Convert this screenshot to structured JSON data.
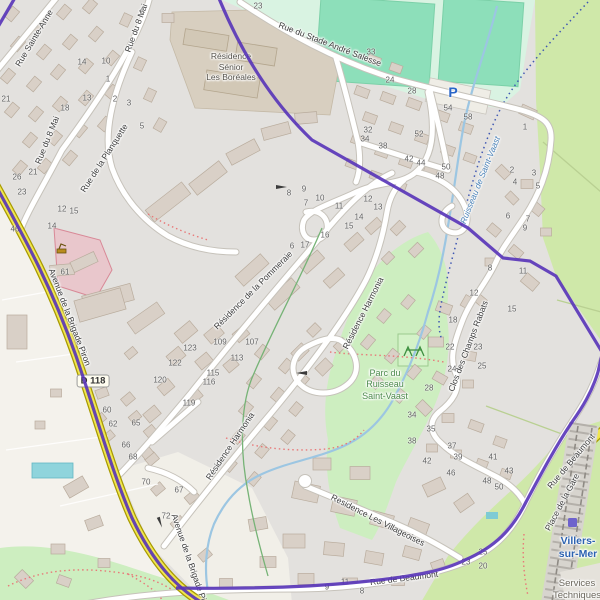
{
  "map": {
    "streets": {
      "sainte_anne": "Rue Sainte-Anne",
      "huit_mai": "Rue du 8 Mai",
      "stade": "Rue du Stade André Salesse",
      "planquette": "Rue de la Planquette",
      "pommeraie": "Résidence de la Pommeraie",
      "harmonia": "Résidence Harmonia",
      "champs_rabats": "Clos des Champs Rabats",
      "villageoises": "Residence Les Villageoises",
      "brigade": "Avenue de la Brigade Piron",
      "beaumont": "Rue de Beaumont",
      "gare": "Place de la Gare"
    },
    "places": {
      "boreales_line1": "Résidence",
      "boreales_line2": "Sénior",
      "boreales_line3": "Les Boréales",
      "parc_line1": "Parc du",
      "parc_line2": "Ruisseau",
      "parc_line3": "Saint-Vaast",
      "ruisseau": "Ruisseau de Saint-Vaast",
      "villers_line1": "Villers-",
      "villers_line2": "sur-Mer",
      "services_line1": "Services",
      "services_line2": "Techniques"
    },
    "markers": {
      "parking": "P",
      "road_ref": "D 118"
    },
    "colors": {
      "c-boundary": "#5633b8",
      "c-road": "#f0e64f",
      "c-water": "#9cc6e2",
      "c-park": "#cdeec0",
      "c-meadow": "#cfe8a9",
      "c-pitch": "#8ddfba",
      "c-city": "#2c62b0"
    },
    "house_numbers": [
      {
        "n": "6",
        "x": 142,
        "y": 12
      },
      {
        "n": "23",
        "x": 258,
        "y": 6
      },
      {
        "n": "33",
        "x": 371,
        "y": 52
      },
      {
        "n": "14",
        "x": 82,
        "y": 62
      },
      {
        "n": "10",
        "x": 106,
        "y": 61
      },
      {
        "n": "1",
        "x": 108,
        "y": 79
      },
      {
        "n": "24",
        "x": 390,
        "y": 80
      },
      {
        "n": "28",
        "x": 412,
        "y": 91
      },
      {
        "n": "21",
        "x": 6,
        "y": 99
      },
      {
        "n": "13",
        "x": 87,
        "y": 98
      },
      {
        "n": "2",
        "x": 115,
        "y": 99
      },
      {
        "n": "3",
        "x": 129,
        "y": 103
      },
      {
        "n": "18",
        "x": 65,
        "y": 108
      },
      {
        "n": "54",
        "x": 448,
        "y": 108
      },
      {
        "n": "58",
        "x": 468,
        "y": 117
      },
      {
        "n": "5",
        "x": 142,
        "y": 126
      },
      {
        "n": "1",
        "x": 525,
        "y": 127
      },
      {
        "n": "32",
        "x": 368,
        "y": 130
      },
      {
        "n": "34",
        "x": 365,
        "y": 139
      },
      {
        "n": "52",
        "x": 419,
        "y": 134
      },
      {
        "n": "38",
        "x": 383,
        "y": 146
      },
      {
        "n": "42",
        "x": 409,
        "y": 159
      },
      {
        "n": "44",
        "x": 421,
        "y": 163
      },
      {
        "n": "50",
        "x": 446,
        "y": 167
      },
      {
        "n": "48",
        "x": 440,
        "y": 176
      },
      {
        "n": "2",
        "x": 512,
        "y": 170
      },
      {
        "n": "21",
        "x": 33,
        "y": 172
      },
      {
        "n": "3",
        "x": 534,
        "y": 173
      },
      {
        "n": "26",
        "x": 17,
        "y": 177
      },
      {
        "n": "4",
        "x": 515,
        "y": 182
      },
      {
        "n": "5",
        "x": 538,
        "y": 186
      },
      {
        "n": "9",
        "x": 304,
        "y": 189
      },
      {
        "n": "23",
        "x": 22,
        "y": 192
      },
      {
        "n": "8",
        "x": 289,
        "y": 193
      },
      {
        "n": "12",
        "x": 368,
        "y": 199
      },
      {
        "n": "10",
        "x": 320,
        "y": 198
      },
      {
        "n": "7",
        "x": 306,
        "y": 203
      },
      {
        "n": "13",
        "x": 378,
        "y": 207
      },
      {
        "n": "11",
        "x": 339,
        "y": 206
      },
      {
        "n": "12",
        "x": 62,
        "y": 209
      },
      {
        "n": "15",
        "x": 74,
        "y": 211
      },
      {
        "n": "6",
        "x": 508,
        "y": 216
      },
      {
        "n": "14",
        "x": 359,
        "y": 217
      },
      {
        "n": "7",
        "x": 528,
        "y": 219
      },
      {
        "n": "15",
        "x": 349,
        "y": 226
      },
      {
        "n": "14",
        "x": 52,
        "y": 226
      },
      {
        "n": "9",
        "x": 525,
        "y": 228
      },
      {
        "n": "46",
        "x": 15,
        "y": 229
      },
      {
        "n": "16",
        "x": 325,
        "y": 235
      },
      {
        "n": "17",
        "x": 305,
        "y": 245
      },
      {
        "n": "6",
        "x": 292,
        "y": 246
      },
      {
        "n": "8",
        "x": 490,
        "y": 268
      },
      {
        "n": "11",
        "x": 523,
        "y": 271
      },
      {
        "n": "61",
        "x": 65,
        "y": 272
      },
      {
        "n": "12",
        "x": 474,
        "y": 293
      },
      {
        "n": "15",
        "x": 512,
        "y": 309
      },
      {
        "n": "18",
        "x": 453,
        "y": 320
      },
      {
        "n": "109",
        "x": 220,
        "y": 342
      },
      {
        "n": "107",
        "x": 252,
        "y": 342
      },
      {
        "n": "22",
        "x": 450,
        "y": 347
      },
      {
        "n": "23",
        "x": 478,
        "y": 347
      },
      {
        "n": "123",
        "x": 190,
        "y": 348
      },
      {
        "n": "113",
        "x": 237,
        "y": 358
      },
      {
        "n": "122",
        "x": 175,
        "y": 363
      },
      {
        "n": "25",
        "x": 482,
        "y": 366
      },
      {
        "n": "24",
        "x": 452,
        "y": 369
      },
      {
        "n": "115",
        "x": 213,
        "y": 373
      },
      {
        "n": "120",
        "x": 160,
        "y": 380
      },
      {
        "n": "116",
        "x": 209,
        "y": 382
      },
      {
        "n": "28",
        "x": 429,
        "y": 388
      },
      {
        "n": "119",
        "x": 189,
        "y": 403
      },
      {
        "n": "60",
        "x": 107,
        "y": 410
      },
      {
        "n": "34",
        "x": 412,
        "y": 415
      },
      {
        "n": "62",
        "x": 113,
        "y": 424
      },
      {
        "n": "65",
        "x": 136,
        "y": 423
      },
      {
        "n": "35",
        "x": 431,
        "y": 429
      },
      {
        "n": "38",
        "x": 412,
        "y": 441
      },
      {
        "n": "66",
        "x": 126,
        "y": 445
      },
      {
        "n": "37",
        "x": 452,
        "y": 446
      },
      {
        "n": "39",
        "x": 458,
        "y": 457
      },
      {
        "n": "41",
        "x": 493,
        "y": 457
      },
      {
        "n": "68",
        "x": 133,
        "y": 457
      },
      {
        "n": "42",
        "x": 427,
        "y": 461
      },
      {
        "n": "43",
        "x": 509,
        "y": 471
      },
      {
        "n": "46",
        "x": 451,
        "y": 473
      },
      {
        "n": "48",
        "x": 487,
        "y": 481
      },
      {
        "n": "70",
        "x": 146,
        "y": 482
      },
      {
        "n": "50",
        "x": 499,
        "y": 487
      },
      {
        "n": "67",
        "x": 179,
        "y": 490
      },
      {
        "n": "72",
        "x": 166,
        "y": 516
      },
      {
        "n": "25",
        "x": 483,
        "y": 552
      },
      {
        "n": "23",
        "x": 466,
        "y": 562
      },
      {
        "n": "20",
        "x": 483,
        "y": 566
      },
      {
        "n": "11",
        "x": 345,
        "y": 582
      },
      {
        "n": "9",
        "x": 327,
        "y": 587
      },
      {
        "n": "8",
        "x": 362,
        "y": 591
      }
    ]
  }
}
